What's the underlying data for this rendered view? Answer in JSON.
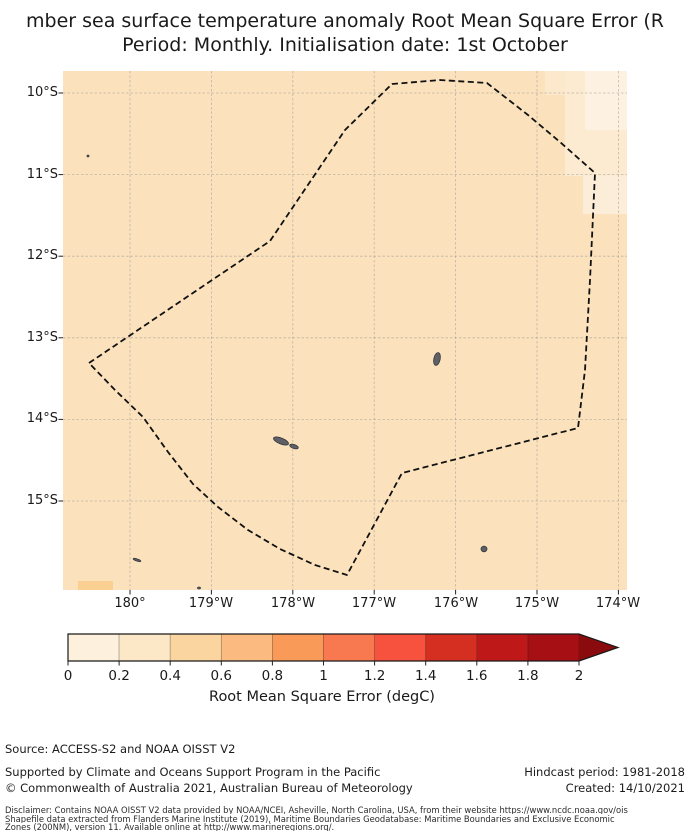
{
  "title": {
    "line1": "mber sea surface temperature anomaly Root Mean Square Error (R",
    "line2": "Period: Monthly. Initialisation date: 1st October"
  },
  "chart_data": {
    "type": "heatmap",
    "description": "Filled lat/lon map of SST anomaly RMSE with dashed EEZ boundary; most cells ~0.4-0.5 degC, lighter cells (~0-0.4) in north-east corner, one warmer cell (~0.6) in south-west corner",
    "map": {
      "plot_px": {
        "width": 564,
        "height": 519
      },
      "base_color": "#FBE2BD",
      "grid_color": "#8f8f8f",
      "boundary_color": "#111111",
      "island_color": "#5e6065",
      "island_edge_color": "#36383c",
      "x_ticks": [
        {
          "label": "180°",
          "px": 67
        },
        {
          "label": "179°W",
          "px": 148.4
        },
        {
          "label": "178°W",
          "px": 229.8
        },
        {
          "label": "177°W",
          "px": 311.2
        },
        {
          "label": "176°W",
          "px": 392.6
        },
        {
          "label": "175°W",
          "px": 474
        },
        {
          "label": "174°W",
          "px": 555.4
        }
      ],
      "y_ticks": [
        {
          "label": "10°S",
          "px": 22
        },
        {
          "label": "11°S",
          "px": 103.6
        },
        {
          "label": "12°S",
          "px": 185.2
        },
        {
          "label": "13°S",
          "px": 266.8
        },
        {
          "label": "14°S",
          "px": 348.4
        },
        {
          "label": "15°S",
          "px": 430
        }
      ],
      "patches": [
        {
          "name": "light-cell-ne-a",
          "x": 482,
          "y": 0,
          "w": 20,
          "h": 24,
          "color": "#FCE8CB"
        },
        {
          "name": "light-block-ne",
          "x": 502,
          "y": 0,
          "w": 62,
          "h": 105,
          "color": "#FCEAD1"
        },
        {
          "name": "very-light-corner",
          "x": 522,
          "y": 0,
          "w": 42,
          "h": 59,
          "color": "#FDF1E1"
        },
        {
          "name": "light-block-ne-low",
          "x": 520,
          "y": 105,
          "w": 44,
          "h": 38,
          "color": "#FCEDD8"
        },
        {
          "name": "warm-cell-sw",
          "x": 15,
          "y": 510,
          "w": 35,
          "h": 9,
          "color": "#FAD092"
        }
      ],
      "eez_boundary": [
        [
          26,
          292
        ],
        [
          207,
          170
        ],
        [
          282,
          59
        ],
        [
          329,
          13
        ],
        [
          377,
          9
        ],
        [
          424,
          12
        ],
        [
          465,
          44
        ],
        [
          497,
          71
        ],
        [
          532,
          102
        ],
        [
          527,
          209
        ],
        [
          522,
          299
        ],
        [
          515,
          357
        ],
        [
          339,
          402
        ],
        [
          284,
          504
        ],
        [
          252,
          494
        ],
        [
          217,
          478
        ],
        [
          185,
          459
        ],
        [
          155,
          436
        ],
        [
          130,
          413
        ],
        [
          105,
          381
        ],
        [
          80,
          346
        ],
        [
          52,
          319
        ],
        [
          26,
          292
        ]
      ],
      "islands": [
        {
          "name": "wallis",
          "cx": 374,
          "cy": 288,
          "rx": 3.2,
          "ry": 6.5,
          "rot": 12
        },
        {
          "name": "futuna",
          "cx": 218,
          "cy": 370,
          "rx": 8,
          "ry": 3,
          "rot": 22
        },
        {
          "name": "alofi",
          "cx": 231,
          "cy": 375.5,
          "rx": 4.5,
          "ry": 2,
          "rot": 18
        },
        {
          "name": "islet-sw",
          "cx": 74,
          "cy": 489,
          "rx": 4,
          "ry": 1.1,
          "rot": 18
        },
        {
          "name": "islet-se",
          "cx": 421,
          "cy": 478,
          "rx": 3,
          "ry": 2.8,
          "rot": 0
        },
        {
          "name": "islet-nw",
          "cx": 25,
          "cy": 85,
          "rx": 1,
          "ry": 1,
          "rot": 0
        },
        {
          "name": "islet-s",
          "cx": 136,
          "cy": 517,
          "rx": 1.5,
          "ry": 1,
          "rot": 0
        }
      ]
    },
    "colorbar": {
      "label": "Root Mean Square Error (degC)",
      "range": [
        0,
        2
      ],
      "bin_step": 0.2,
      "tick_labels": [
        "0",
        "0.2",
        "0.4",
        "0.6",
        "0.8",
        "1",
        "1.2",
        "1.4",
        "1.6",
        "1.8",
        "2"
      ],
      "bin_colors": [
        "#FDF0DC",
        "#FCE7C6",
        "#FBD5A0",
        "#FBBB80",
        "#FA9A59",
        "#F87850",
        "#F6523E",
        "#D52F21",
        "#BF1818",
        "#A60F14"
      ],
      "over_color": "#8A0B0D",
      "outline_color": "#1a1a1a"
    }
  },
  "footer": {
    "source": "Source: ACCESS-S2 and NOAA OISST V2",
    "supported": "Supported by Climate and Oceans Support Program in the Pacific",
    "copyright": "© Commonwealth of Australia 2021, Australian Bureau of Meteorology",
    "hindcast": "Hindcast period: 1981-2018",
    "created": "Created: 14/10/2021",
    "disclaimer_line1": "Disclaimer: Contains NOAA OISST V2 data provided by NOAA/NCEI, Asheville, North Carolina, USA, from their website https://www.ncdc.noaa.gov/ois",
    "disclaimer_line2": "Shapefile data extracted from Flanders Marine Institute (2019), Maritime Boundaries Geodatabase: Maritime Boundaries and Exclusive Economic",
    "disclaimer_line3": "Zones (200NM), version 11. Available online at http://www.marineregions.org/."
  }
}
